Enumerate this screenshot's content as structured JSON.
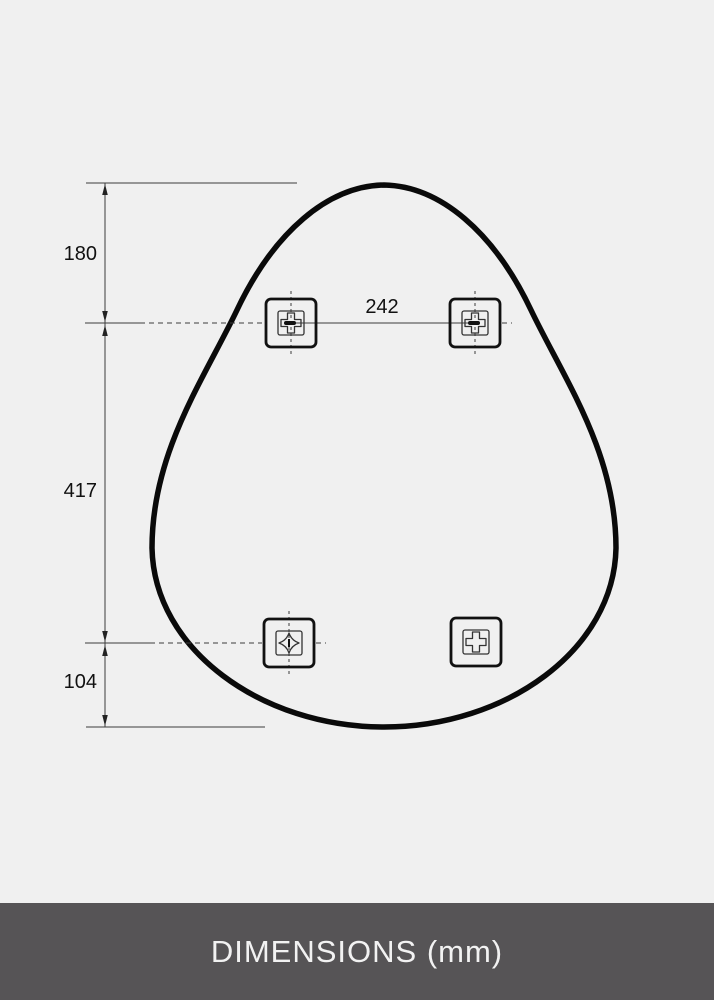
{
  "footer": {
    "label": "DIMENSIONS (mm)",
    "bar_color": "#565456",
    "text_color": "#f2f2f2"
  },
  "colors": {
    "background": "#f0f0f0",
    "outline": "#0a0a0a",
    "dimension_line": "#3d3d3d",
    "label_text": "#111111"
  },
  "diagram": {
    "shape": "egg-shaped mirror outline with four mounting brackets",
    "unit": "mm",
    "labels": {
      "top_offset": "180",
      "bracket_spacing": "242",
      "middle_span": "417",
      "bottom_offset": "104"
    },
    "brackets": [
      {
        "position": "top-left"
      },
      {
        "position": "top-right"
      },
      {
        "position": "bottom-left"
      },
      {
        "position": "bottom-right"
      }
    ]
  }
}
